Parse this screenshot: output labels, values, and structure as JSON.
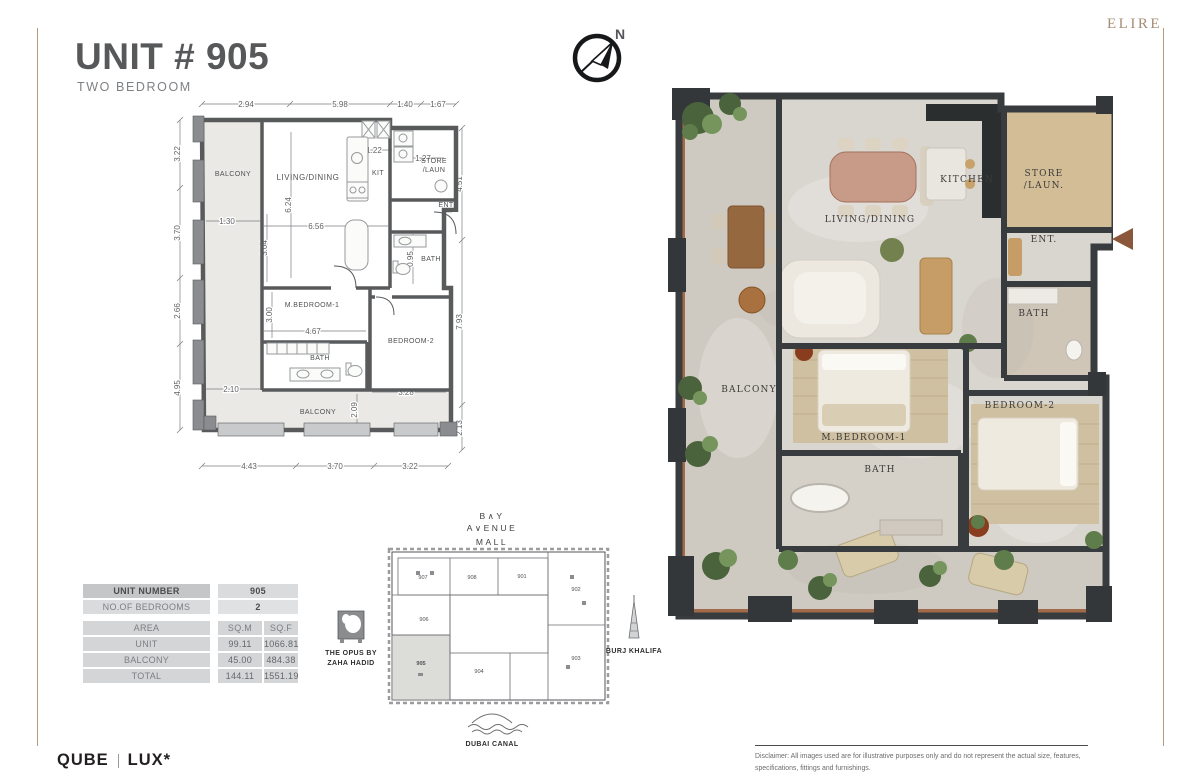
{
  "header": {
    "title": "UNIT # 905",
    "subtitle": "TWO BEDROOM",
    "brand": "ELIRE",
    "compass_north": "N"
  },
  "plan2d": {
    "rooms": {
      "balcony_top": "BALCONY",
      "living": "LIVING/DINING",
      "kit": "KIT",
      "store1": "STORE",
      "store2": "/LAUN",
      "ent": "ENT",
      "bath_top": "BATH",
      "mbedroom": "M.BEDROOM-1",
      "bedroom2": "BEDROOM-2",
      "bath_low": "BATH",
      "balcony_bottom": "BALCONY"
    },
    "dims": {
      "top": [
        "2.94",
        "5.98",
        "1.40",
        "1.67"
      ],
      "left": [
        "3.22",
        "3.70",
        "2.66",
        "4.95"
      ],
      "right": [
        "4.51",
        "7.93",
        "2.13"
      ],
      "bottom": [
        "4.43",
        "3.70",
        "3.22"
      ],
      "inner": [
        "1.22",
        "1.27",
        "6.24",
        "6.56",
        "1.30",
        "3.04",
        "0.95",
        "3.00",
        "4.67",
        "2.10",
        "3.28",
        "2.09"
      ]
    }
  },
  "plan3d": {
    "rooms": {
      "kitchen": "KITCHEN",
      "store1": "STORE",
      "store2": "/LAUN.",
      "living": "LIVING/DINING",
      "ent": "ENT.",
      "bath_top": "BATH",
      "balcony": "BALCONY",
      "mbedroom": "M.BEDROOM-1",
      "bath_low": "BATH",
      "bedroom2": "BEDROOM-2"
    }
  },
  "keyplan": {
    "mall_line1": "B∧Y",
    "mall_line2": "A∨ENUE",
    "mall_line3": "MALL",
    "opus_line1": "THE OPUS BY",
    "opus_line2": "ZAHA HADID",
    "burj": "BURJ KHALIFA",
    "canal": "DUBAI CANAL",
    "units": {
      "u907": "907",
      "u908": "908",
      "u901": "901",
      "u902": "902",
      "u906": "906",
      "u905": "905",
      "u904": "904",
      "u903": "903"
    },
    "highlighted_unit": "905"
  },
  "table": {
    "unit_number_label": "UNIT NUMBER",
    "unit_number_value": "905",
    "bedrooms_label": "NO.OF BEDROOMS",
    "bedrooms_value": "2",
    "area_label": "AREA",
    "sqm_header": "SQ.M",
    "sqf_header": "SQ.F",
    "rows": [
      {
        "label": "UNIT",
        "sqm": "99.11",
        "sqf": "1066.81"
      },
      {
        "label": "BALCONY",
        "sqm": "45.00",
        "sqf": "484.38"
      },
      {
        "label": "TOTAL",
        "sqm": "144.11",
        "sqf": "1551.19"
      }
    ]
  },
  "footer": {
    "logo_left": "QUBE",
    "logo_right": "LUX*",
    "disclaimer": "Disclaimer: All images used are for illustrative purposes only and do not represent the actual size, features, specifications, fittings and furnishings."
  },
  "colors": {
    "title_gray": "#57585a",
    "brand_tan": "#a58c74",
    "border_tan": "#b49b80",
    "wall_gray": "#58595b",
    "balcony_fill": "#eae9e5",
    "render_wall": "#383c3e",
    "render_floor": "#d9d5cf",
    "render_wood": "#a26a48",
    "plant_green": "#5f7d4b",
    "entry_arrow_brown": "#8a573a",
    "table_row_dark": "#c5c6c8",
    "table_row_light": "#d4d5d7"
  }
}
